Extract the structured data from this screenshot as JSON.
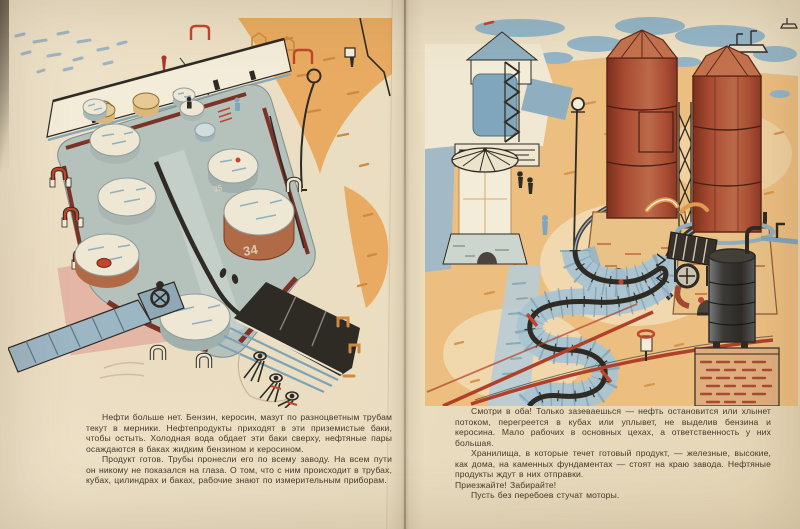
{
  "colors": {
    "paper": "#e9ddc2",
    "ink": "#44392b",
    "maroon_pipe": "#7c3224",
    "signal_red": "#c0462e",
    "tower_red": "#a84b32",
    "blue_gray": "#8aa7b7",
    "sand_orange": "#e8ab61",
    "pink_road": "#e2b0a0",
    "water_blue": "#93b5c7",
    "lith_black": "#2e2a24"
  },
  "left_page": {
    "tank_labels": [
      "35",
      "34"
    ],
    "paragraphs": [
      "Нефти больше нет. Бензин, керосин, мазут по разноцветным трубам текут в мерники. Нефтепродукты приходят в эти приземистые баки, чтобы остыть. Холодная вода обдает эти баки сверху, нефтяные пары осаждаются в баках жидким бензином и керосином.",
      "Продукт готов. Трубы пронесли его по всему заводу. На всем пути он никому не показался на глаза. О том, что с ним происходит в трубах, кубах, цилиндрах и баках, рабочие знают по измерительным приборам."
    ]
  },
  "right_page": {
    "paragraphs": [
      "Смотри в оба! Только зазеваешься — нефть остановится или хлынет потоком, перегреется в кубах или уплывет, не выделив бензина и керосина. Мало рабочих в основных цехах, а ответственность у них большая.",
      "Хранилища, в которые течет готовый продукт, — железные, высокие, как дома, на каменных фундаментах — стоят на краю завода. Нефтяные продукты ждут в них отправки.",
      "Приезжайте! Забирайте!",
      "Пусть без перебоев стучат моторы."
    ]
  }
}
